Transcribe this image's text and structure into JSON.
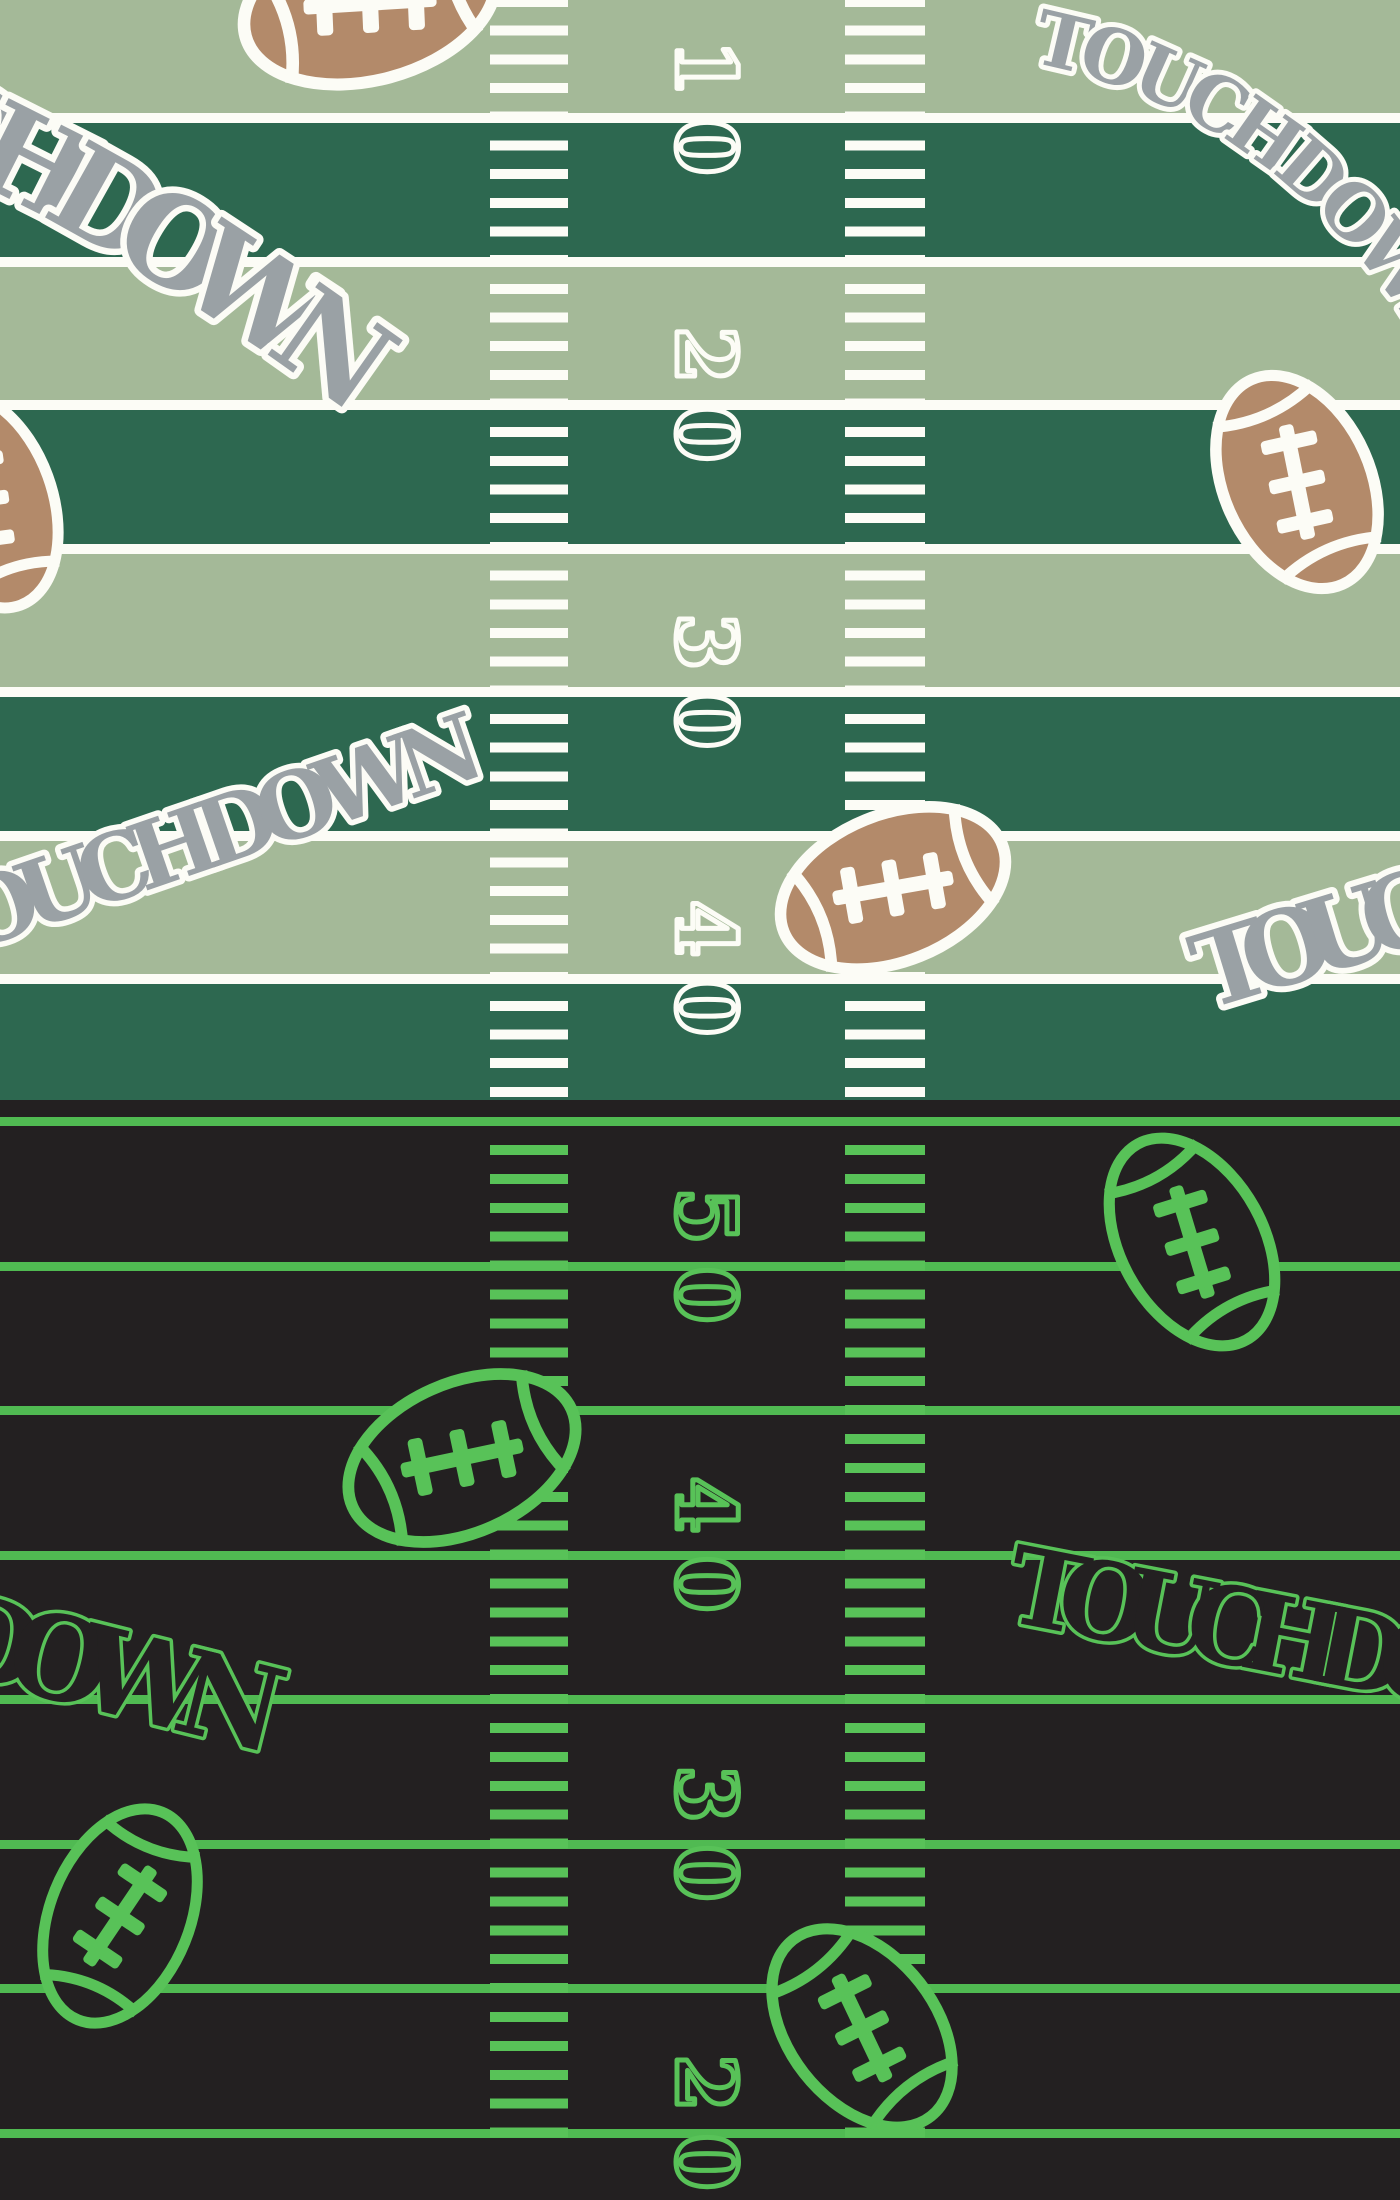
{
  "pattern": {
    "touchdown_label": "TOUCHDOWN",
    "day_field": {
      "yard_numbers": [
        "10",
        "20",
        "30",
        "40"
      ]
    },
    "night_field": {
      "yard_numbers": [
        "50",
        "40",
        "30",
        "20"
      ]
    }
  },
  "colors": {
    "field_stripe_light": "#a4b998",
    "field_stripe_dark": "#2d6850",
    "field_line_white": "#fcfcf6",
    "football_brown": "#b38a6a",
    "touchdown_gray": "#9aa1a5",
    "night_background": "#232021",
    "neon_green": "#58c258",
    "neon_line_green": "#50ba52"
  }
}
